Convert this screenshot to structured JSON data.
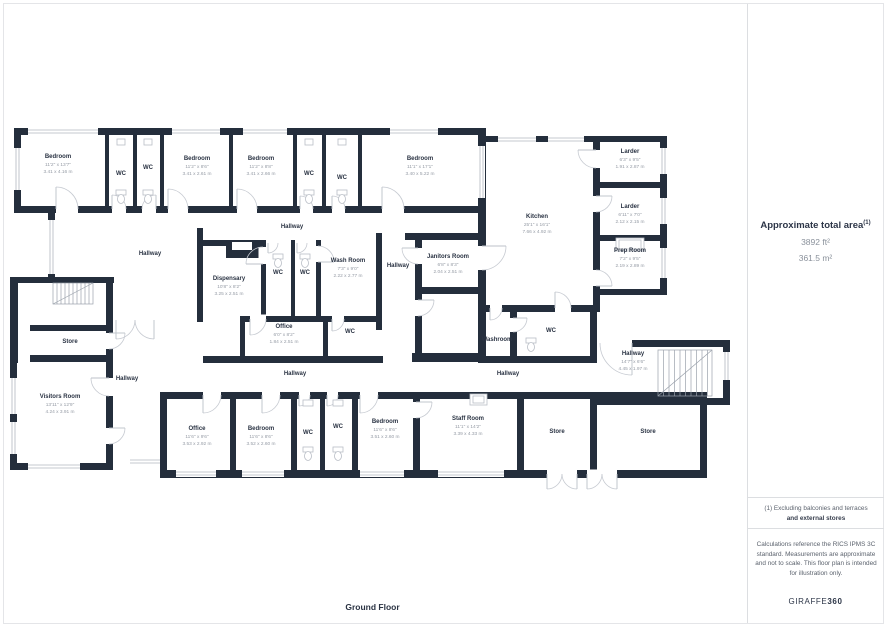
{
  "floor_label": "Ground Floor",
  "colors": {
    "wall": "#242e3c",
    "room_name": "#2a3343",
    "dimension_text": "#959ba5"
  },
  "panel": {
    "area_title": "Approximate total area",
    "area_sup": "(1)",
    "area_ft": "3892 ft²",
    "area_m": "361.5 m²",
    "note1_line1": "(1) Excluding balconies and terraces",
    "note1_line2": "and external stores",
    "note2": "Calculations reference the RICS IPMS 3C standard. Measurements are approximate and not to scale. This floor plan is intended for illustration only.",
    "brand_regular": "GIRAFFE",
    "brand_bold": "360"
  },
  "labels": {
    "wc": "WC",
    "hallway": "Hallway",
    "store": "Store",
    "washroom": "Washroom"
  },
  "rooms": {
    "bedroom_tl": {
      "name": "Bedroom",
      "ft": "11'2\" x 13'7\"",
      "m": "3.41 x 4.16 m"
    },
    "bedroom_t2": {
      "name": "Bedroom",
      "ft": "11'2\" x 8'6\"",
      "m": "3.41 x 2.61 m"
    },
    "bedroom_t3": {
      "name": "Bedroom",
      "ft": "11'2\" x 8'8\"",
      "m": "3.41 x 2.66 m"
    },
    "bedroom_t4": {
      "name": "Bedroom",
      "ft": "11'1\" x 17'1\"",
      "m": "3.40 x 5.22 m"
    },
    "kitchen": {
      "name": "Kitchen",
      "ft": "25'1\" x 16'1\"",
      "m": "7.66 x 4.92 m"
    },
    "larder_1": {
      "name": "Larder",
      "ft": "6'3\" x 9'5\"",
      "m": "1.91 x 2.87 m"
    },
    "larder_2": {
      "name": "Larder",
      "ft": "6'11\" x 7'0\"",
      "m": "2.12 x 2.15 m"
    },
    "prep_room": {
      "name": "Prep Room",
      "ft": "7'2\" x 9'5\"",
      "m": "2.19 x 2.89 m"
    },
    "dispensary": {
      "name": "Dispensary",
      "ft": "10'8\" x 8'2\"",
      "m": "3.25 x 2.51 m"
    },
    "wash_room": {
      "name": "Wash Room",
      "ft": "7'3\" x 9'0\"",
      "m": "2.22 x 2.77 m"
    },
    "janitors_room": {
      "name": "Janitors Room",
      "ft": "6'8\" x 8'3\"",
      "m": "2.04 x 2.51 m"
    },
    "office_mid": {
      "name": "Office",
      "ft": "6'0\" x 8'2\"",
      "m": "1.84 x 2.51 m"
    },
    "visitors_room": {
      "name": "Visitors Room",
      "ft": "13'11\" x 12'9\"",
      "m": "4.24 x 3.91 m"
    },
    "office_bottom": {
      "name": "Office",
      "ft": "11'6\" x 9'6\"",
      "m": "3.53 x 2.92 m"
    },
    "bedroom_b1": {
      "name": "Bedroom",
      "ft": "11'6\" x 8'6\"",
      "m": "3.52 x 2.60 m"
    },
    "bedroom_b2": {
      "name": "Bedroom",
      "ft": "11'6\" x 8'6\"",
      "m": "3.51 x 2.60 m"
    },
    "staff_room": {
      "name": "Staff Room",
      "ft": "11'1\" x 14'2\"",
      "m": "3.39 x 4.33 m"
    },
    "hallway_stairs": {
      "name": "Hallway",
      "ft": "14'7\" x 6'6\"",
      "m": "4.45 x 1.97 m"
    }
  }
}
